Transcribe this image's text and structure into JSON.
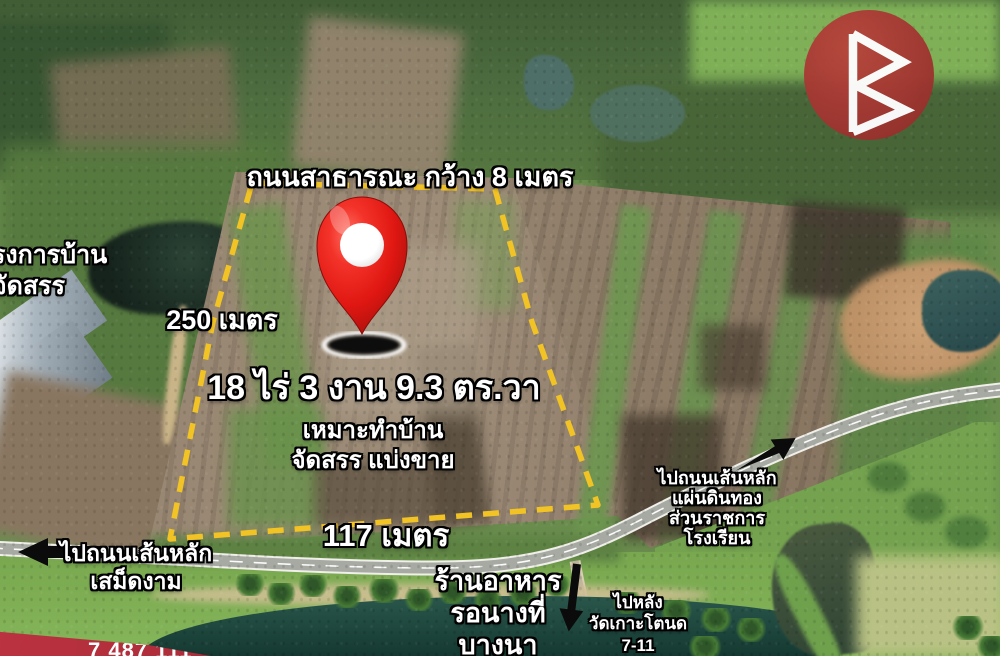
{
  "colors": {
    "accent_yellow": "#f2c324",
    "pin_red": "#e8231d",
    "logo_red": "#a13631",
    "banner_red": "#a52a36",
    "text": "#ffffff",
    "outline": "#000000"
  },
  "plot": {
    "road_label": "ถนนสาธารณะ กว้าง 8 เมตร",
    "width_left": "250 เมตร",
    "width_bottom": "117 เมตร",
    "area": "18 ไร่ 3 งาน 9.3 ตร.วา",
    "suitability": {
      "line1": "เหมาะทำบ้าน",
      "line2": "จัดสรร แบ่งขาย"
    }
  },
  "labels": {
    "project": {
      "line1": "รงการบ้าน",
      "line2": "จัดสรร"
    },
    "west": {
      "line1": "ไปถนนเส้นหลัก",
      "line2": "เสม็ดงาม"
    },
    "restaurant": {
      "line1": "ร้านอาหาร",
      "line2": "รอนางที่",
      "line3": "บางนา"
    },
    "south": {
      "line1": "ไปหลัง",
      "line2": "วัดเกาะโตนด",
      "line3": "7-11"
    },
    "east": {
      "line1": "ไปถนนเส้นหลัก",
      "line2": "แผ่นดินทอง",
      "line3": "ส่วนราชการ",
      "line4": "โรงเรียน"
    }
  },
  "banner": {
    "partial_text": "7 487 111"
  },
  "icons": {
    "marker": "map-pin",
    "logo": "triangle-b-monogram",
    "west_arrow": "arrow-left",
    "south_arrow": "arrow-down",
    "east_arrow": "arrow-up-right"
  }
}
